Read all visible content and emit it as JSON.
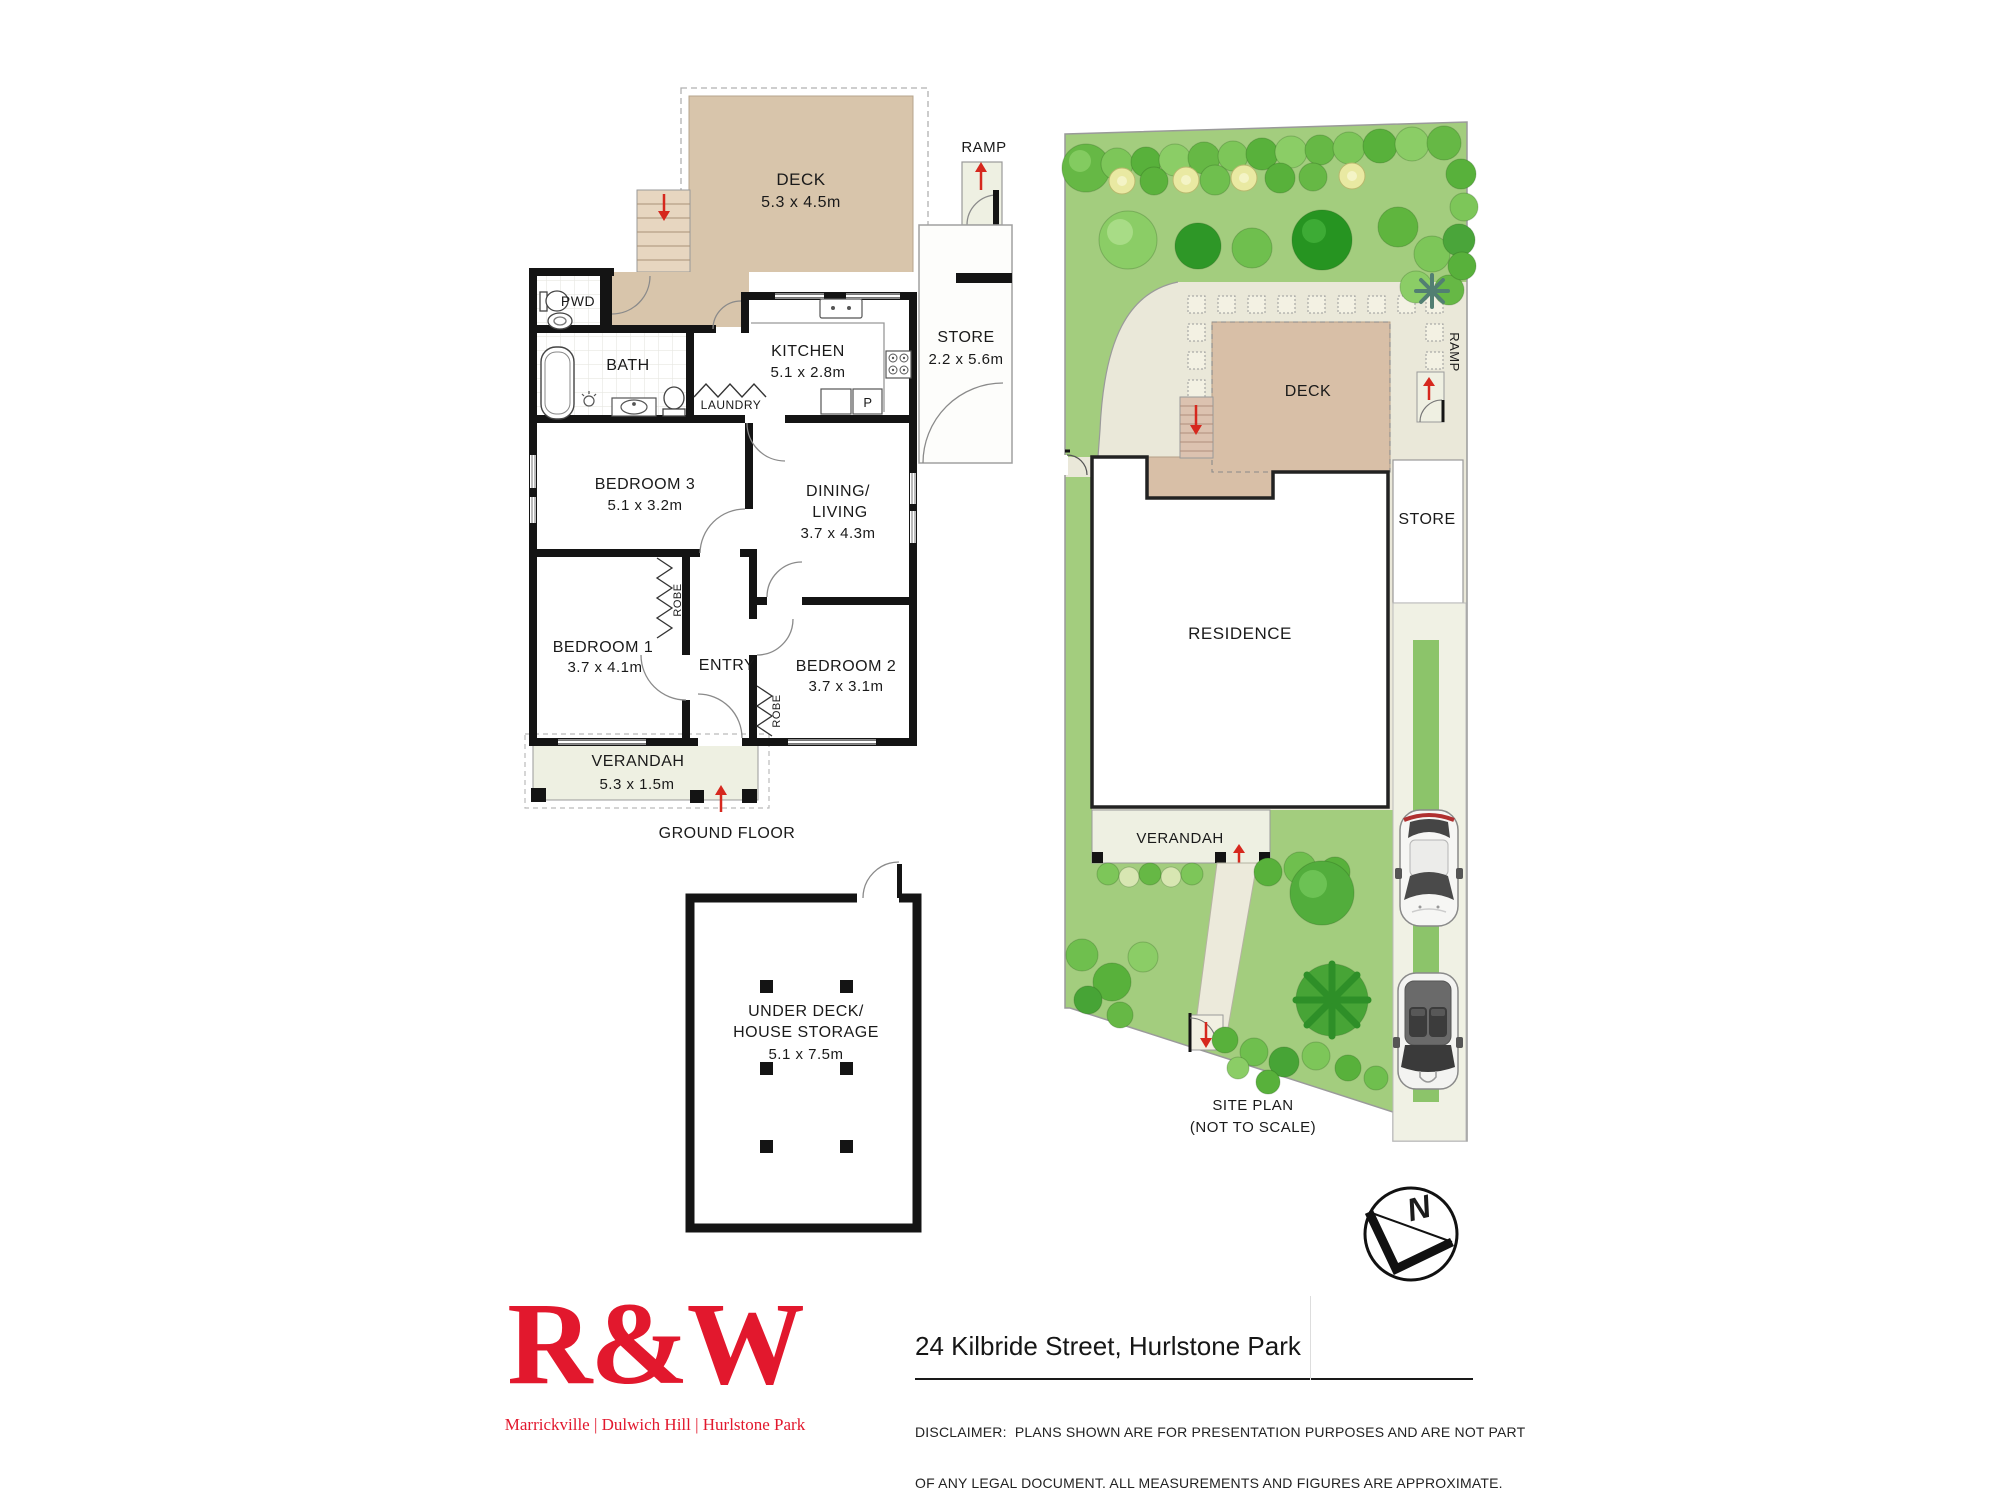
{
  "ground_floor": {
    "deck": {
      "label": "DECK",
      "dims": "5.3 x 4.5m"
    },
    "ramp_label": "RAMP",
    "store": {
      "label": "STORE",
      "dims": "2.2 x 5.6m"
    },
    "pwd_label": "PWD",
    "bath_label": "BATH",
    "laundry_label": "LAUNDRY",
    "kitchen": {
      "label": "KITCHEN",
      "dims": "5.1 x 2.8m"
    },
    "pantry_label": "P",
    "bedroom3": {
      "label": "BEDROOM 3",
      "dims": "5.1 x 3.2m"
    },
    "dining": {
      "line1": "DINING/",
      "line2": "LIVING",
      "dims": "3.7 x 4.3m"
    },
    "bedroom1": {
      "label": "BEDROOM 1",
      "dims": "3.7 x 4.1m"
    },
    "entry_label": "ENTRY",
    "bedroom2": {
      "label": "BEDROOM 2",
      "dims": "3.7 x 3.1m"
    },
    "robe_label": "ROBE",
    "verandah": {
      "label": "VERANDAH",
      "dims": "5.3 x 1.5m"
    },
    "caption": "GROUND FLOOR",
    "storage": {
      "line1": "UNDER DECK/",
      "line2": "HOUSE STORAGE",
      "dims": "5.1 x 7.5m"
    }
  },
  "site_plan": {
    "deck_label": "DECK",
    "store_label": "STORE",
    "ramp_label": "RAMP",
    "residence_label": "RESIDENCE",
    "verandah_label": "VERANDAH",
    "caption_line1": "SITE PLAN",
    "caption_line2": "(NOT TO SCALE)",
    "north_label": "N"
  },
  "footer": {
    "logo_text": "R&W",
    "logo_tagline": "Marrickville | Dulwich Hill | Hurlstone Park",
    "address": "24 Kilbride Street, Hurlstone Park",
    "disclaimer_line1": "DISCLAIMER:  PLANS SHOWN ARE FOR PRESENTATION PURPOSES AND ARE NOT PART",
    "disclaimer_line2": "OF ANY LEGAL DOCUMENT. ALL MEASUREMENTS AND FIGURES ARE APPROXIMATE."
  },
  "colors": {
    "brand_red": "#e2182d",
    "arrow_red": "#d6281e",
    "deck_tan": "#d8c5ab",
    "lawn_green": "#a3cd7e",
    "wall_black": "#141414"
  }
}
